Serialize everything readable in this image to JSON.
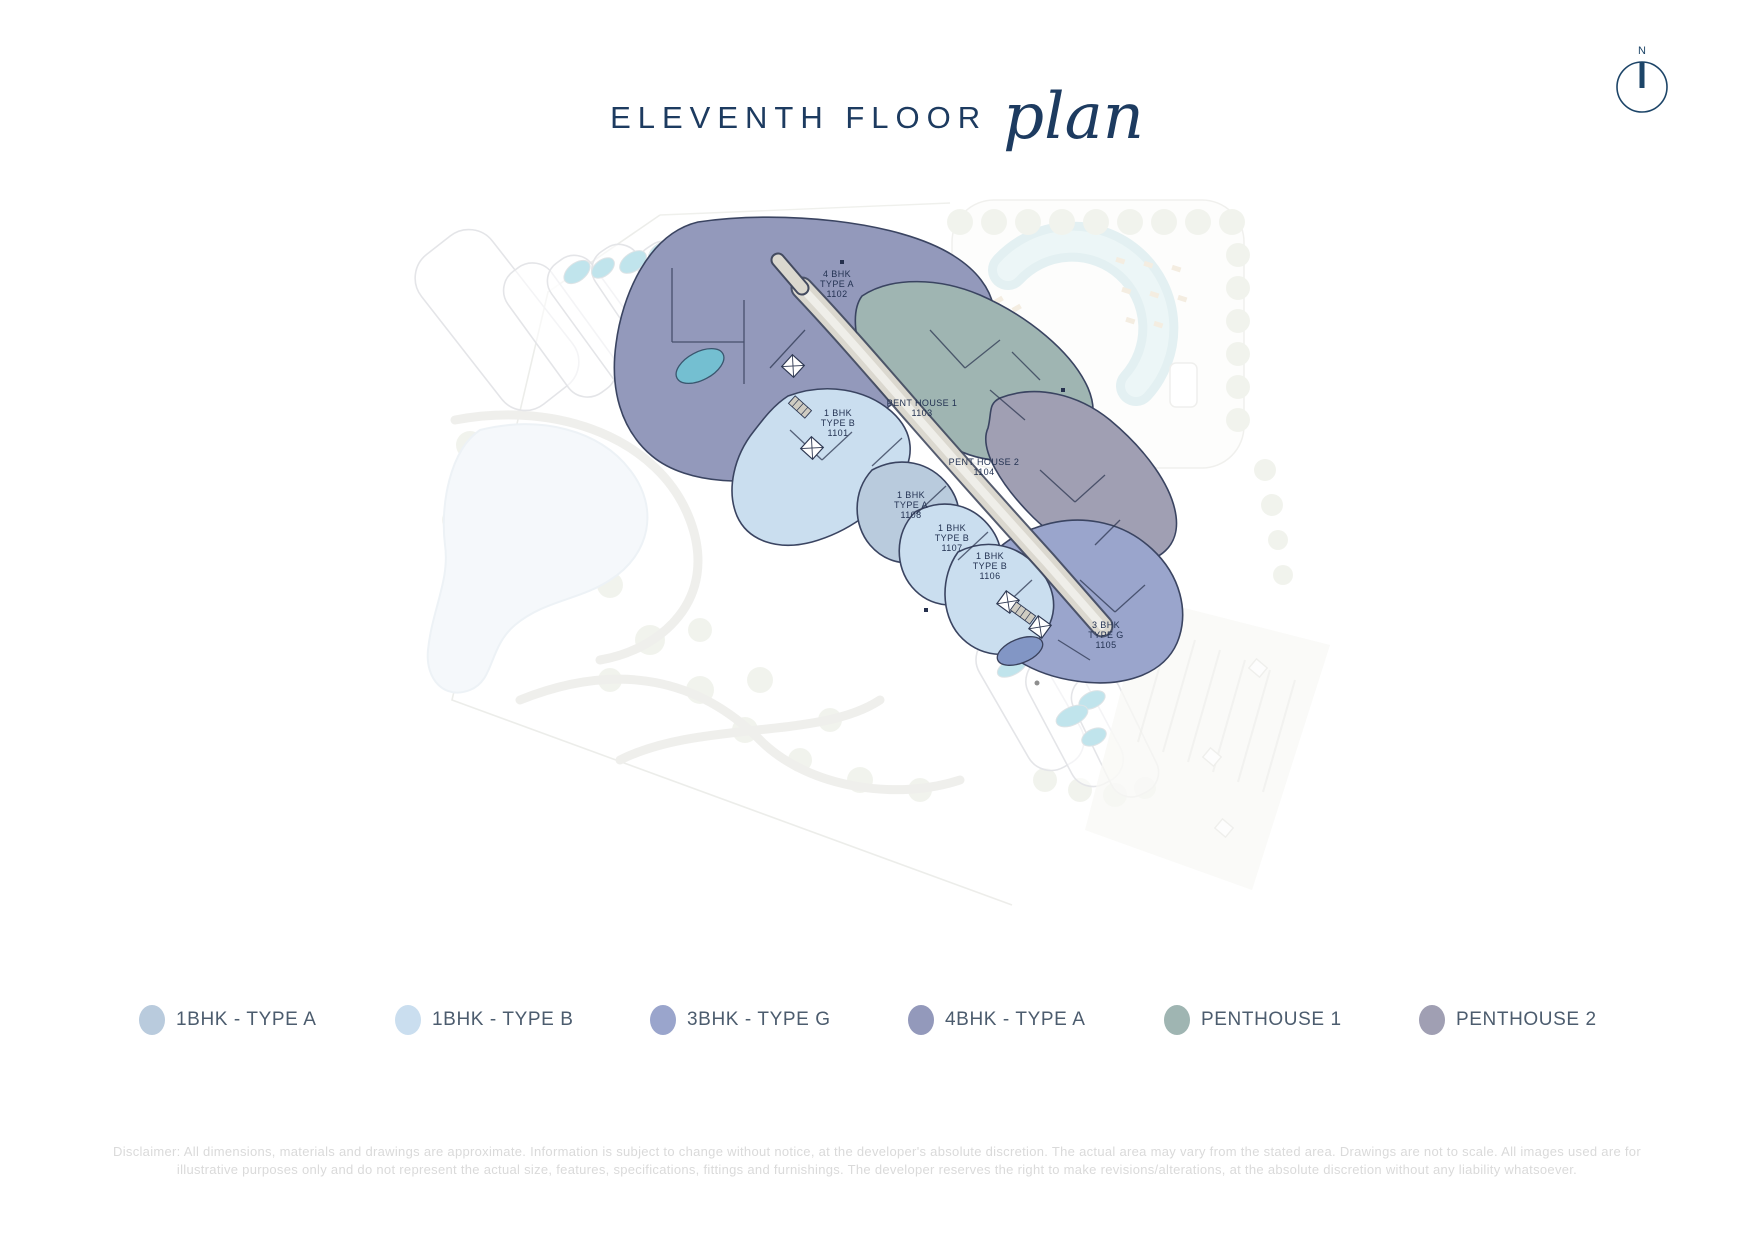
{
  "title": {
    "main": "ELEVENTH FLOOR",
    "script": "plan"
  },
  "compass": {
    "label": "N",
    "color": "#1d4568"
  },
  "legend": {
    "items": [
      {
        "label": "1BHK - TYPE A",
        "color": "#b9cbdd"
      },
      {
        "label": "1BHK - TYPE B",
        "color": "#cadeef"
      },
      {
        "label": "3BHK - TYPE G",
        "color": "#9aa5cc"
      },
      {
        "label": "4BHK - TYPE A",
        "color": "#9399bb"
      },
      {
        "label": "PENTHOUSE 1",
        "color": "#9fb5b2"
      },
      {
        "label": "PENTHOUSE 2",
        "color": "#a09fb3"
      }
    ]
  },
  "plan": {
    "units": [
      {
        "id": "1102",
        "lines": [
          "4 BHK",
          "TYPE A",
          "1102"
        ],
        "legend": "4BHK - TYPE A"
      },
      {
        "id": "1101",
        "lines": [
          "1 BHK",
          "TYPE B",
          "1101"
        ],
        "legend": "1BHK - TYPE B"
      },
      {
        "id": "1103",
        "lines": [
          "PENT HOUSE 1",
          "1103"
        ],
        "legend": "PENTHOUSE 1"
      },
      {
        "id": "1104",
        "lines": [
          "PENT HOUSE 2",
          "1104"
        ],
        "legend": "PENTHOUSE 2"
      },
      {
        "id": "1108",
        "lines": [
          "1 BHK",
          "TYPE A",
          "1108"
        ],
        "legend": "1BHK - TYPE A"
      },
      {
        "id": "1107",
        "lines": [
          "1 BHK",
          "TYPE B",
          "1107"
        ],
        "legend": "1BHK - TYPE B"
      },
      {
        "id": "1106",
        "lines": [
          "1 BHK",
          "TYPE B",
          "1106"
        ],
        "legend": "1BHK - TYPE B"
      },
      {
        "id": "1105",
        "lines": [
          "3 BHK",
          "TYPE G",
          "1105"
        ],
        "legend": "3BHK - TYPE G"
      }
    ],
    "wall_color": "#2e3852",
    "pool_color": "#74bfd1",
    "ghost_pool_color": "#8ecfdd",
    "corridor_color": "#dbd8cf"
  },
  "disclaimer": {
    "line1": "Disclaimer: All dimensions, materials and drawings are approximate. Information is subject to change without notice, at the developer's absolute discretion. The actual area may vary from the stated area. Drawings are not to scale. All images used are for",
    "line2": "illustrative purposes only and do not represent the actual size, features, specifications, fittings and furnishings. The developer reserves the right to make revisions/alterations, at the absolute discretion without any liability whatsoever."
  }
}
